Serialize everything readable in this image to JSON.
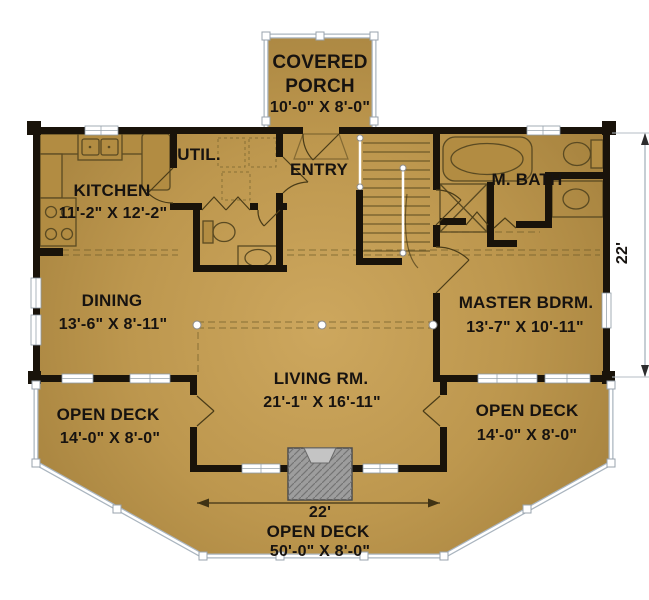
{
  "plan_title": "Log Home Main Floor Plan",
  "rooms": {
    "covered_porch": {
      "line1": "COVERED",
      "line2": "PORCH",
      "dims": "10'-0\" X 8'-0\""
    },
    "util": {
      "name": "UTIL."
    },
    "entry": {
      "name": "ENTRY"
    },
    "kitchen": {
      "name": "KITCHEN",
      "dims": "11'-2\" X 12'-2\""
    },
    "m_bath": {
      "name": "M. BATH"
    },
    "dining": {
      "name": "DINING",
      "dims": "13'-6\" X 8'-11\""
    },
    "master_bdrm": {
      "name": "MASTER BDRM.",
      "dims": "13'-7\" X 10'-11\""
    },
    "living_rm": {
      "name": "LIVING RM.",
      "dims": "21'-1\" X 16'-11\""
    },
    "open_deck_left": {
      "name": "OPEN DECK",
      "dims": "14'-0\" X 8'-0\""
    },
    "open_deck_right": {
      "name": "OPEN DECK",
      "dims": "14'-0\" X 8'-0\""
    },
    "open_deck_bottom": {
      "name": "OPEN DECK",
      "dims": "50'-0\" X 8'-0\""
    }
  },
  "dimensions": {
    "right_depth": "22'",
    "living_width": "22'"
  },
  "colors": {
    "floor_center": "#cda75e",
    "floor_edge": "#a07d3a",
    "wall": "#19130a",
    "fireplace": "#9d9d9d",
    "railing": "#aab5bf",
    "text": "#171310"
  }
}
